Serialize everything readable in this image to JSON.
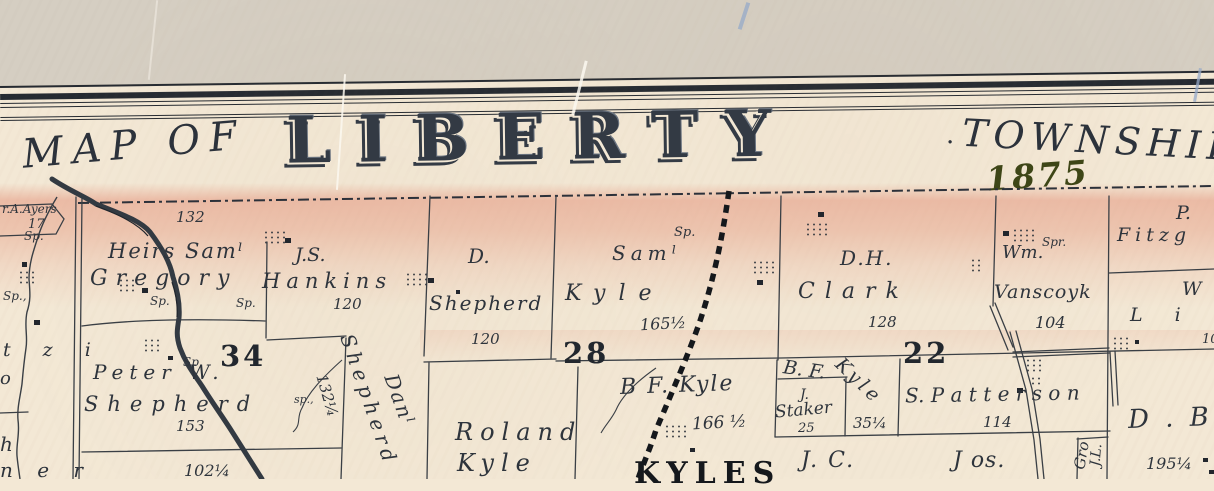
{
  "frame": {
    "title_prefix": "MAP OF",
    "title_main": "LIBERTY",
    "title_separator": "·",
    "title_suffix": "TOWNSHIP",
    "year": "1875"
  },
  "sections": {
    "s34": "34",
    "s28": "28",
    "s22": "22"
  },
  "markers": {
    "spring": "Sp.",
    "spring_comma": "Sp.,",
    "spring_small": "sp.,",
    "spring_alt": "Spr."
  },
  "parcels": {
    "ayers": {
      "name": "r.A.Ayers",
      "acres": "17"
    },
    "gregory": {
      "acres": "132",
      "name1": "Heirs Samˡ",
      "name2": "Gregory"
    },
    "hankins": {
      "name1": "J.S.",
      "name2": "Hankins",
      "acres": "120"
    },
    "d_shepherd": {
      "name1": "D.",
      "name2": "Shepherd",
      "acres": "120"
    },
    "sam_kyle": {
      "name1": "Samˡ",
      "name2": "Kyle",
      "acres": "165½"
    },
    "clark": {
      "name1": "D.H.",
      "name2": "Clark",
      "acres": "128"
    },
    "vanscoyk": {
      "name1": "Wm.",
      "name2": "Vanscoyk",
      "acres": "104"
    },
    "fitzgerald": {
      "name1": "P.",
      "name2": "Fitzg"
    },
    "linn": {
      "name1": "W",
      "name2": "L i n",
      "acres": "10"
    },
    "pw_shepherd": {
      "name1": "Peter W.",
      "name2": "Shepherd",
      "acres": "153",
      "strip_acres": "132¼",
      "south_acres": "102¼"
    },
    "danl_shepherd": {
      "name1": "Danˡ",
      "name2": "Shepherd"
    },
    "roland_kyle": {
      "name1": "Roland",
      "name2": "Kyle"
    },
    "bf_kyle_28": {
      "name": "B F. Kyle",
      "acres": "166 ½"
    },
    "bf_kyle_22": {
      "name1": "B. F.",
      "name2": "Kyle",
      "acres": "35¼"
    },
    "staker": {
      "name1": "J.",
      "name2": "Staker",
      "acres": "25"
    },
    "patterson": {
      "name": "S. P a t t e r s o n",
      "acres": "114"
    },
    "jc": {
      "name": "J. C."
    },
    "jos": {
      "name": "J os."
    },
    "grover": {
      "name1": "J.L.",
      "name2": "Gro"
    },
    "d_be": {
      "name": "D . B e",
      "acres": "195¼"
    }
  },
  "station": {
    "name": "KYLES"
  },
  "edge_fragments": {
    "f1": "t z i",
    "f2": "o",
    "f3": "h",
    "f4": "n e r"
  },
  "colors": {
    "outer_background": "#d5cec2",
    "paper": "#f3e8d5",
    "pink_shading": "#e89680",
    "ink": "#2e343c",
    "year_green": "#3e4617",
    "railroad": "#15181c"
  }
}
